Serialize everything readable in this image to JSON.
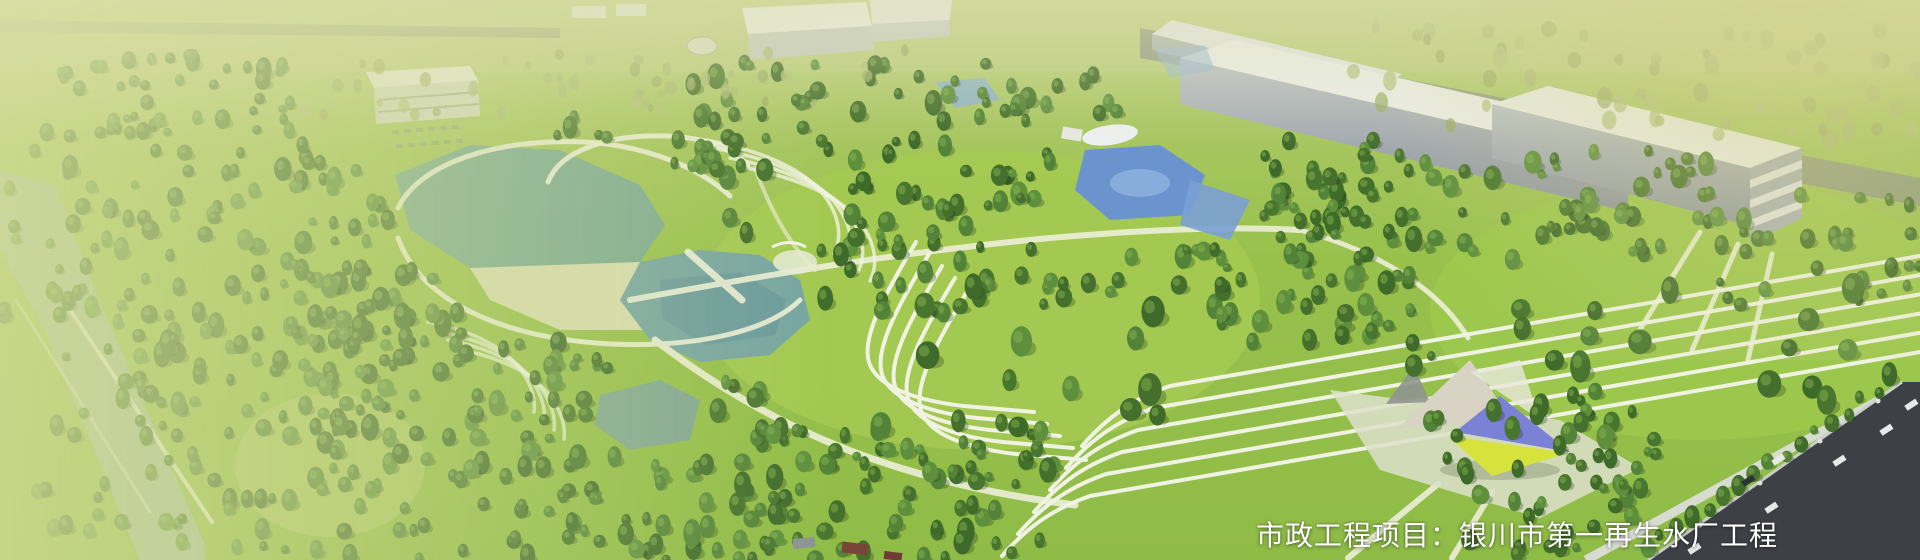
{
  "banner": {
    "caption": "市政工程项目：银川市第一再生水厂工程",
    "palette": {
      "lawn": "#98c14c",
      "lawn_bright": "#a4ca52",
      "lawn_top_haze": "#c6d388",
      "tree_dark": "#49762f",
      "tree_highlight": "#8cb755",
      "water_lake": "#76a5a2",
      "water_canal": "#a3bda0",
      "water_pool_blue": "#6b94cf",
      "beach_sand": "#d7dcae",
      "building_white": "#eceeea",
      "building_side": "#aab0b6",
      "road_dark": "#3d4146",
      "path_light": "#eef0d8",
      "wash_green": "#d5dd9a",
      "pavilion_blue": "#7b82d6",
      "pavilion_yellow": "#d8e23c",
      "caption_color": "#ffffff"
    }
  }
}
